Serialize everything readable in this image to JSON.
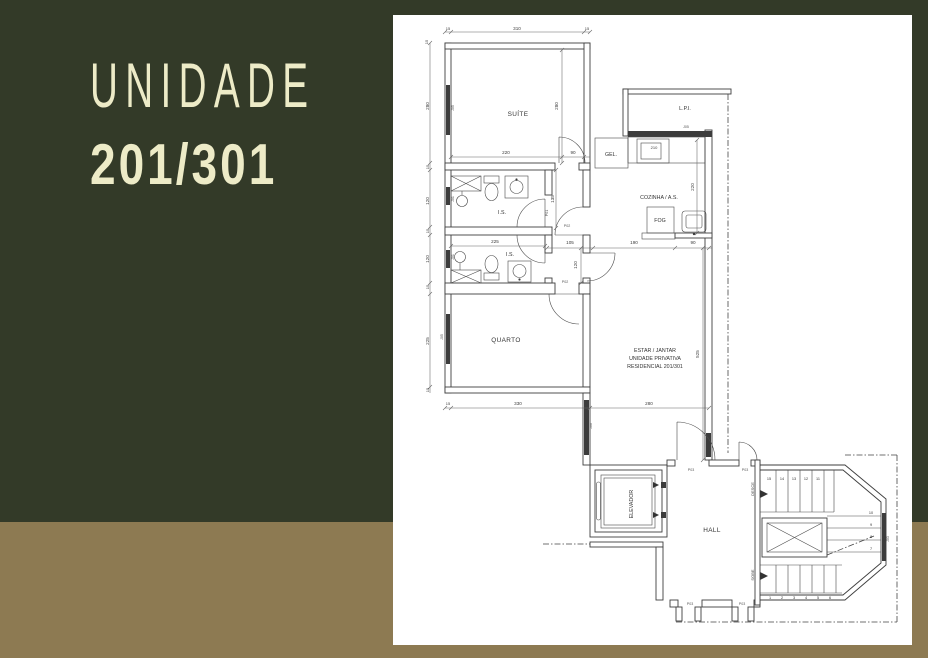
{
  "title": {
    "line1": "UNIDADE",
    "line2": "201/301"
  },
  "colors": {
    "background_green": "#333A28",
    "background_tan": "#8D7A52",
    "title_text": "#EDEBC7",
    "paper": "#FFFFFF",
    "drawing_line": "#3E3E3E"
  },
  "plan": {
    "rooms": {
      "suite": "SUÍTE",
      "lpi": "L.P.I.",
      "gel": "GEL.",
      "cozinha": "COZINHA / A.S.",
      "fog": "FOG",
      "is1": "I.S.",
      "is2": "I.S.",
      "quarto": "QUARTO",
      "estar_line1": "ESTAR / JANTAR",
      "estar_line2": "UNIDADE PRIVATIVA",
      "estar_line3": "RESIDENCIAL 201/301",
      "elevador": "ELEVADOR",
      "hall": "HALL",
      "desce": "DESCE",
      "sobe": "SOBE"
    },
    "dims": {
      "top15a": "15",
      "top310": "310",
      "top15b": "15",
      "l15w": "15",
      "l280": "280",
      "l15a": "15",
      "l120a": "120",
      "l15b": "15",
      "l120b": "120",
      "l15c": "15",
      "l225": "225",
      "l15d": "15",
      "s280": "280",
      "s220": "220",
      "s90": "90",
      "b135": "135",
      "b225": "225",
      "m105": "105",
      "m190": "190",
      "m90": "90",
      "m120": "120",
      "k220": "220",
      "k210": "210",
      "e525": "525",
      "bo15": "15",
      "bo330": "330",
      "bo280": "280"
    },
    "tags": {
      "p01": "P01",
      "p02a": "P02",
      "p02b": "P02",
      "p03_hall_top": "P03",
      "p03_stair_top": "P03",
      "p03_hall_bottom": "P03",
      "p03_stair_bottom": "P03",
      "j05a": "J05",
      "j01a": "J01",
      "j01b": "J01",
      "j05b": "J05",
      "j05c": "J05",
      "j06": "J06",
      "j03": "J03"
    },
    "stairs": {
      "top_flight": [
        "15",
        "14",
        "13",
        "12",
        "11"
      ],
      "right_flight": [
        "10",
        "9",
        "8",
        "7"
      ],
      "bottom_flight": [
        "1",
        "2",
        "3",
        "4",
        "5",
        "6"
      ]
    }
  }
}
